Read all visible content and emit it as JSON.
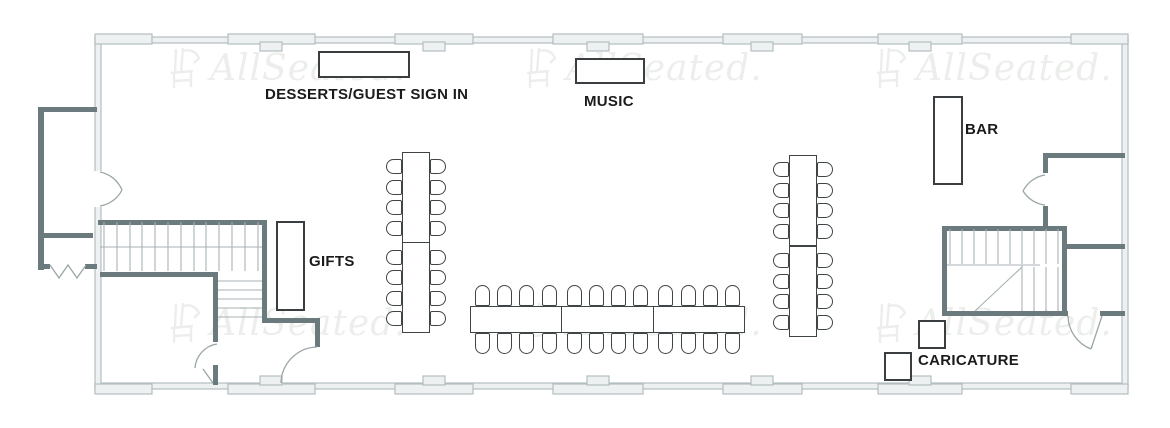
{
  "app": {
    "name": "AllSeated floor plan"
  },
  "colors": {
    "wall_thin": "#b3bec0",
    "wall_thin_fill": "#eef1f1",
    "wall_thick": "#6b7a7d",
    "stair_tread": "#a8b2b4",
    "furniture_outline": "#3f4446",
    "furniture_fill": "#ffffff",
    "label_text": "#1b1b1b",
    "watermark": "#eceeec"
  },
  "watermark": {
    "text": "AllSeated.",
    "icon": "chair-logo-icon",
    "positions": [
      {
        "x": 168,
        "y": 46
      },
      {
        "x": 524,
        "y": 46
      },
      {
        "x": 874,
        "y": 46
      },
      {
        "x": 168,
        "y": 301
      },
      {
        "x": 524,
        "y": 301
      },
      {
        "x": 874,
        "y": 301
      }
    ]
  },
  "labels": {
    "desserts": {
      "text": "DESSERTS/GUEST SIGN IN"
    },
    "music": {
      "text": "MUSIC"
    },
    "bar": {
      "text": "BAR"
    },
    "gifts": {
      "text": "GIFTS"
    },
    "caricature": {
      "text": "CARICATURE"
    }
  },
  "stations": [
    {
      "id": "dessert-guest-sign-in-table",
      "x": 318,
      "y": 51,
      "w": 92,
      "h": 27
    },
    {
      "id": "music-table",
      "x": 575,
      "y": 58,
      "w": 70,
      "h": 26
    },
    {
      "id": "bar-table",
      "x": 933,
      "y": 96,
      "w": 30,
      "h": 89
    },
    {
      "id": "gifts-table",
      "x": 276,
      "y": 221,
      "w": 29,
      "h": 90
    },
    {
      "id": "caricature-table-1",
      "x": 918,
      "y": 320,
      "w": 28,
      "h": 29
    },
    {
      "id": "caricature-table-2",
      "x": 884,
      "y": 352,
      "w": 28,
      "h": 29
    }
  ],
  "tables": [
    {
      "id": "banquet-table-left",
      "orientation": "vertical",
      "x": 402,
      "y": 152,
      "w": 28,
      "h": 181,
      "sections": 2,
      "seats_per_side": 8,
      "total_seats": 16,
      "chair": {
        "w": 16,
        "h": 15
      }
    },
    {
      "id": "banquet-table-right",
      "orientation": "vertical",
      "x": 789,
      "y": 155,
      "w": 28,
      "h": 182,
      "sections": 2,
      "seats_per_side": 8,
      "total_seats": 16,
      "chair": {
        "w": 16,
        "h": 15
      }
    },
    {
      "id": "head-table",
      "orientation": "horizontal",
      "x": 470,
      "y": 306,
      "w": 275,
      "h": 27,
      "sections": 3,
      "seats_per_side": 12,
      "total_seats": 24,
      "chair": {
        "w": 15,
        "h": 21
      }
    }
  ]
}
